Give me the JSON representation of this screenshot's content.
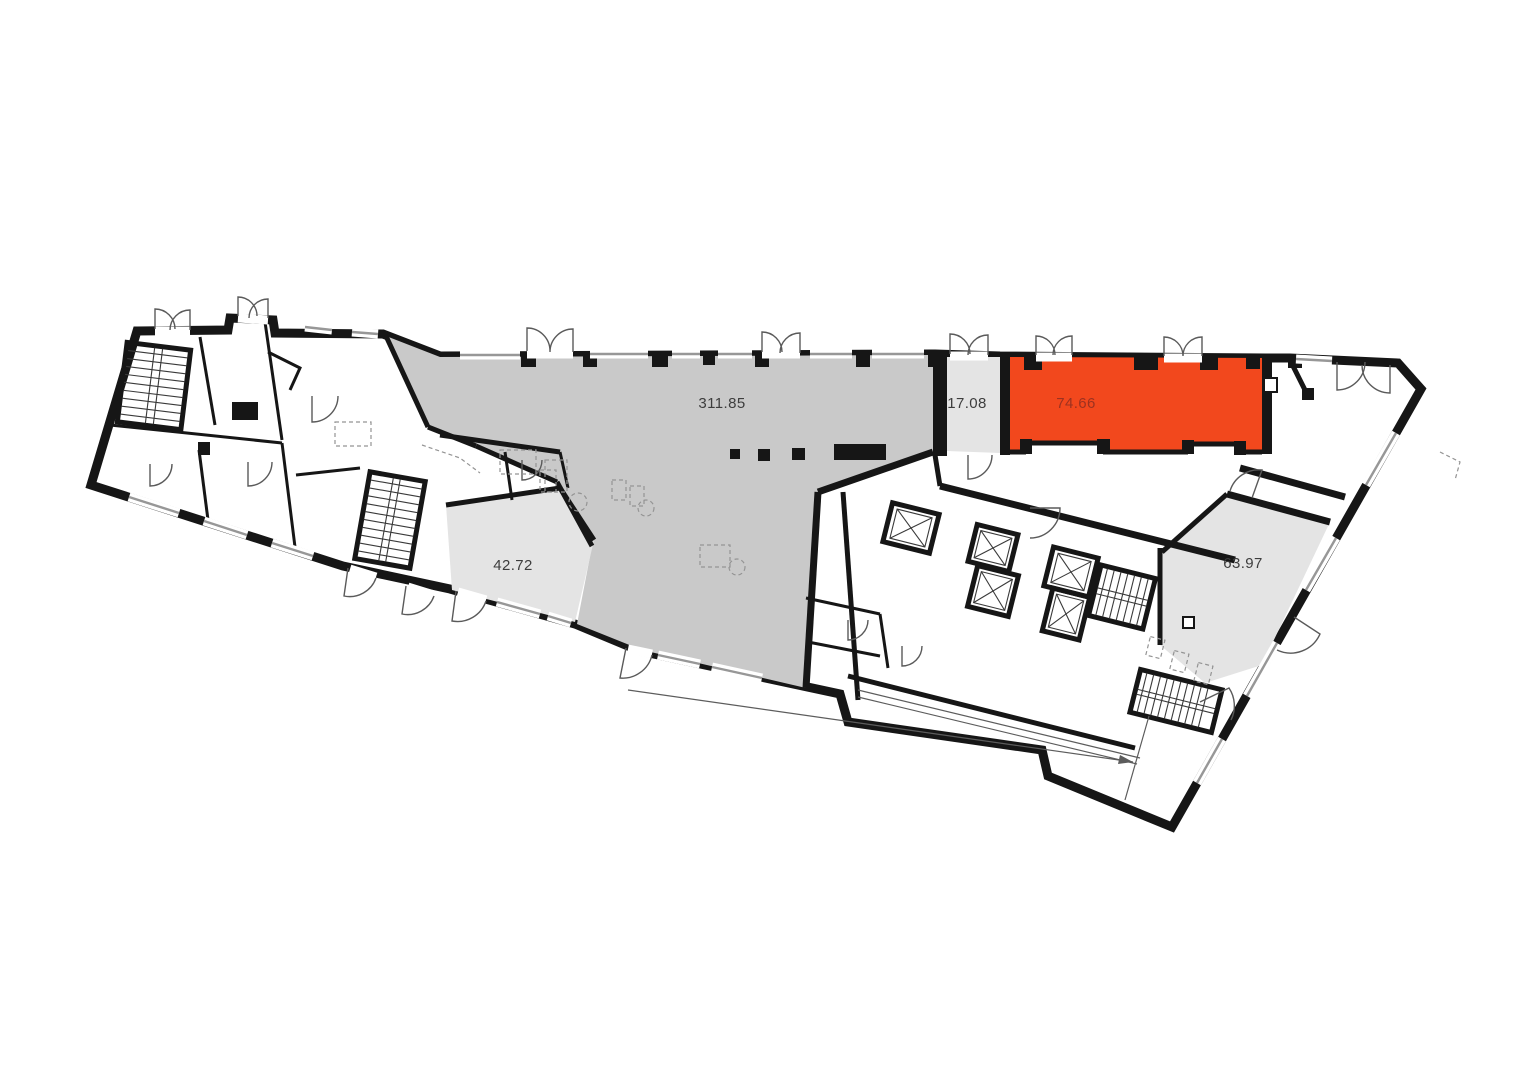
{
  "plan": {
    "title": "building-floor-plan",
    "background": "#ffffff",
    "colors": {
      "wall": "#161616",
      "open_space_fill": "#c9c9c9",
      "unit_fill": "#e4e4e4",
      "highlight_fill": "#f2481d",
      "highlight_label": "#9c3220",
      "label": "#3d3d3d",
      "window": "#979797",
      "dimension": "#5c5c5c"
    },
    "units": [
      {
        "id": "open-space",
        "area": "311.85",
        "highlighted": false
      },
      {
        "id": "lobby",
        "area": "17.08",
        "highlighted": false
      },
      {
        "id": "selected-unit",
        "area": "74.66",
        "highlighted": true
      },
      {
        "id": "unit-42",
        "area": "42.72",
        "highlighted": false
      },
      {
        "id": "unit-63",
        "area": "63.97",
        "highlighted": false
      }
    ]
  }
}
